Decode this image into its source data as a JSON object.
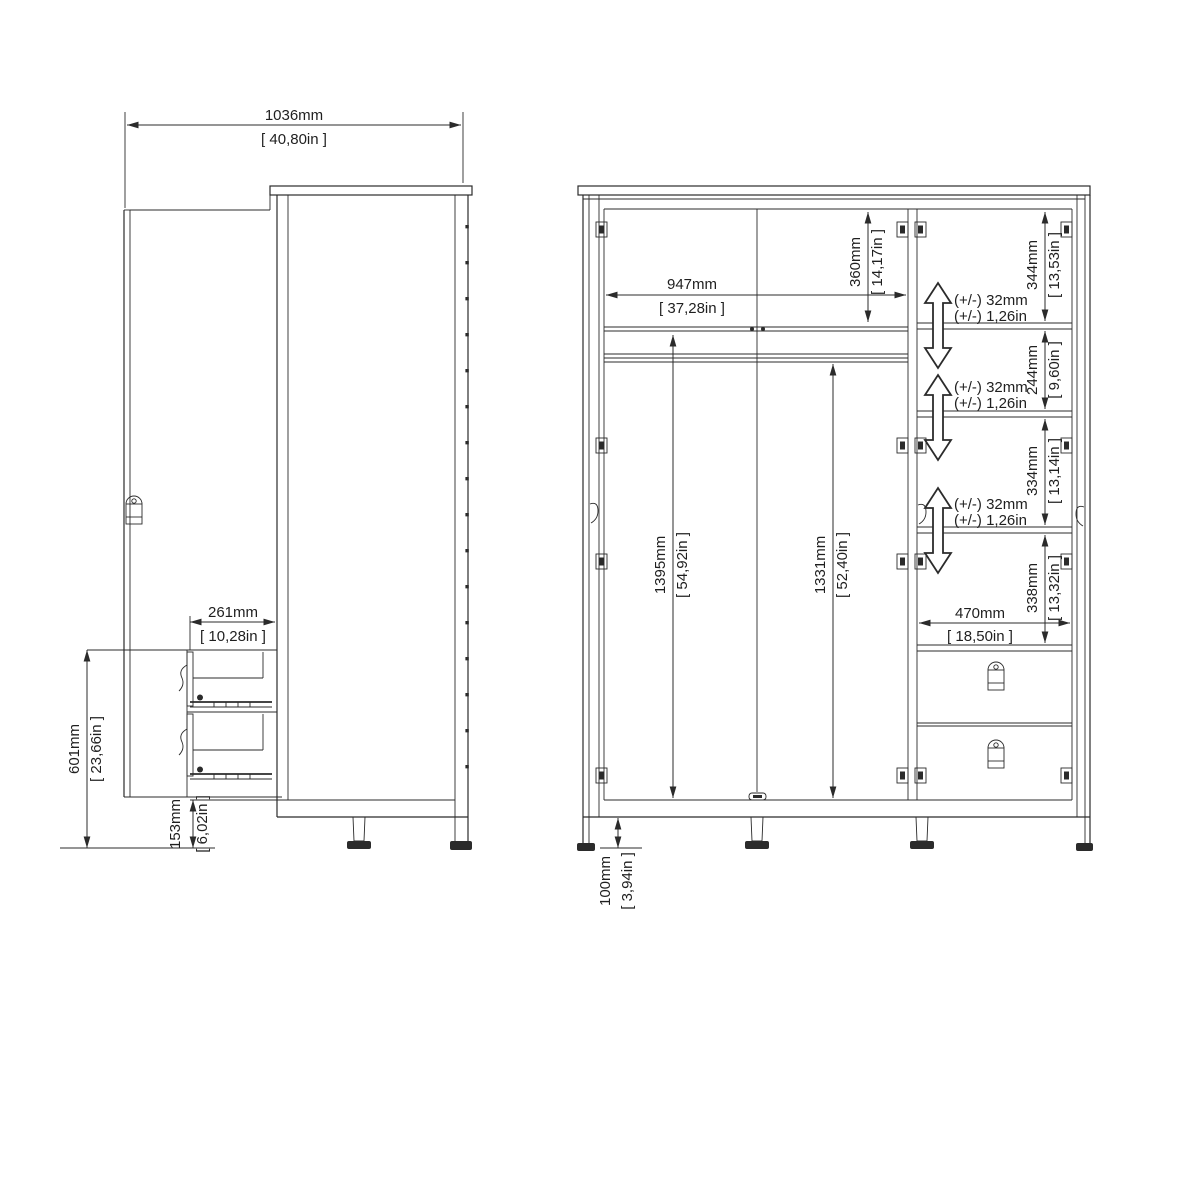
{
  "colors": {
    "line": "#2b2b2b",
    "text": "#1f1f1f",
    "background": "#ffffff"
  },
  "side_view": {
    "dims": {
      "total_depth": {
        "mm": "1036mm",
        "inch": "[ 40,80in ]"
      },
      "drawer_extension": {
        "mm": "261mm",
        "inch": "[ 10,28in ]"
      },
      "drawer_unit_height": {
        "mm": "601mm",
        "inch": "[ 23,66in ]"
      },
      "plinth_height": {
        "mm": "153mm",
        "inch": "[ 6,02in ]"
      }
    }
  },
  "front_view": {
    "dims": {
      "interior_width": {
        "mm": "947mm",
        "inch": "[ 37,28in ]"
      },
      "top_compartment_height": {
        "mm": "360mm",
        "inch": "[ 14,17in ]"
      },
      "left_hanging_height": {
        "mm": "1395mm",
        "inch": "[ 54,92in ]"
      },
      "right_hanging_height": {
        "mm": "1331mm",
        "inch": "[ 52,40in ]"
      },
      "compartment_1_height": {
        "mm": "344mm",
        "inch": "[ 13,53in ]"
      },
      "compartment_2_height": {
        "mm": "244mm",
        "inch": "[ 9,60in ]"
      },
      "compartment_3_height": {
        "mm": "334mm",
        "inch": "[ 13,14in ]"
      },
      "compartment_4_height": {
        "mm": "338mm",
        "inch": "[ 13,32in ]"
      },
      "compartment_width": {
        "mm": "470mm",
        "inch": "[ 18,50in ]"
      },
      "foot_height": {
        "mm": "100mm",
        "inch": "[ 3,94in ]"
      },
      "shelf_adjustability": {
        "mm": "(+/-) 32mm",
        "inch": "(+/-) 1,26in"
      }
    }
  }
}
